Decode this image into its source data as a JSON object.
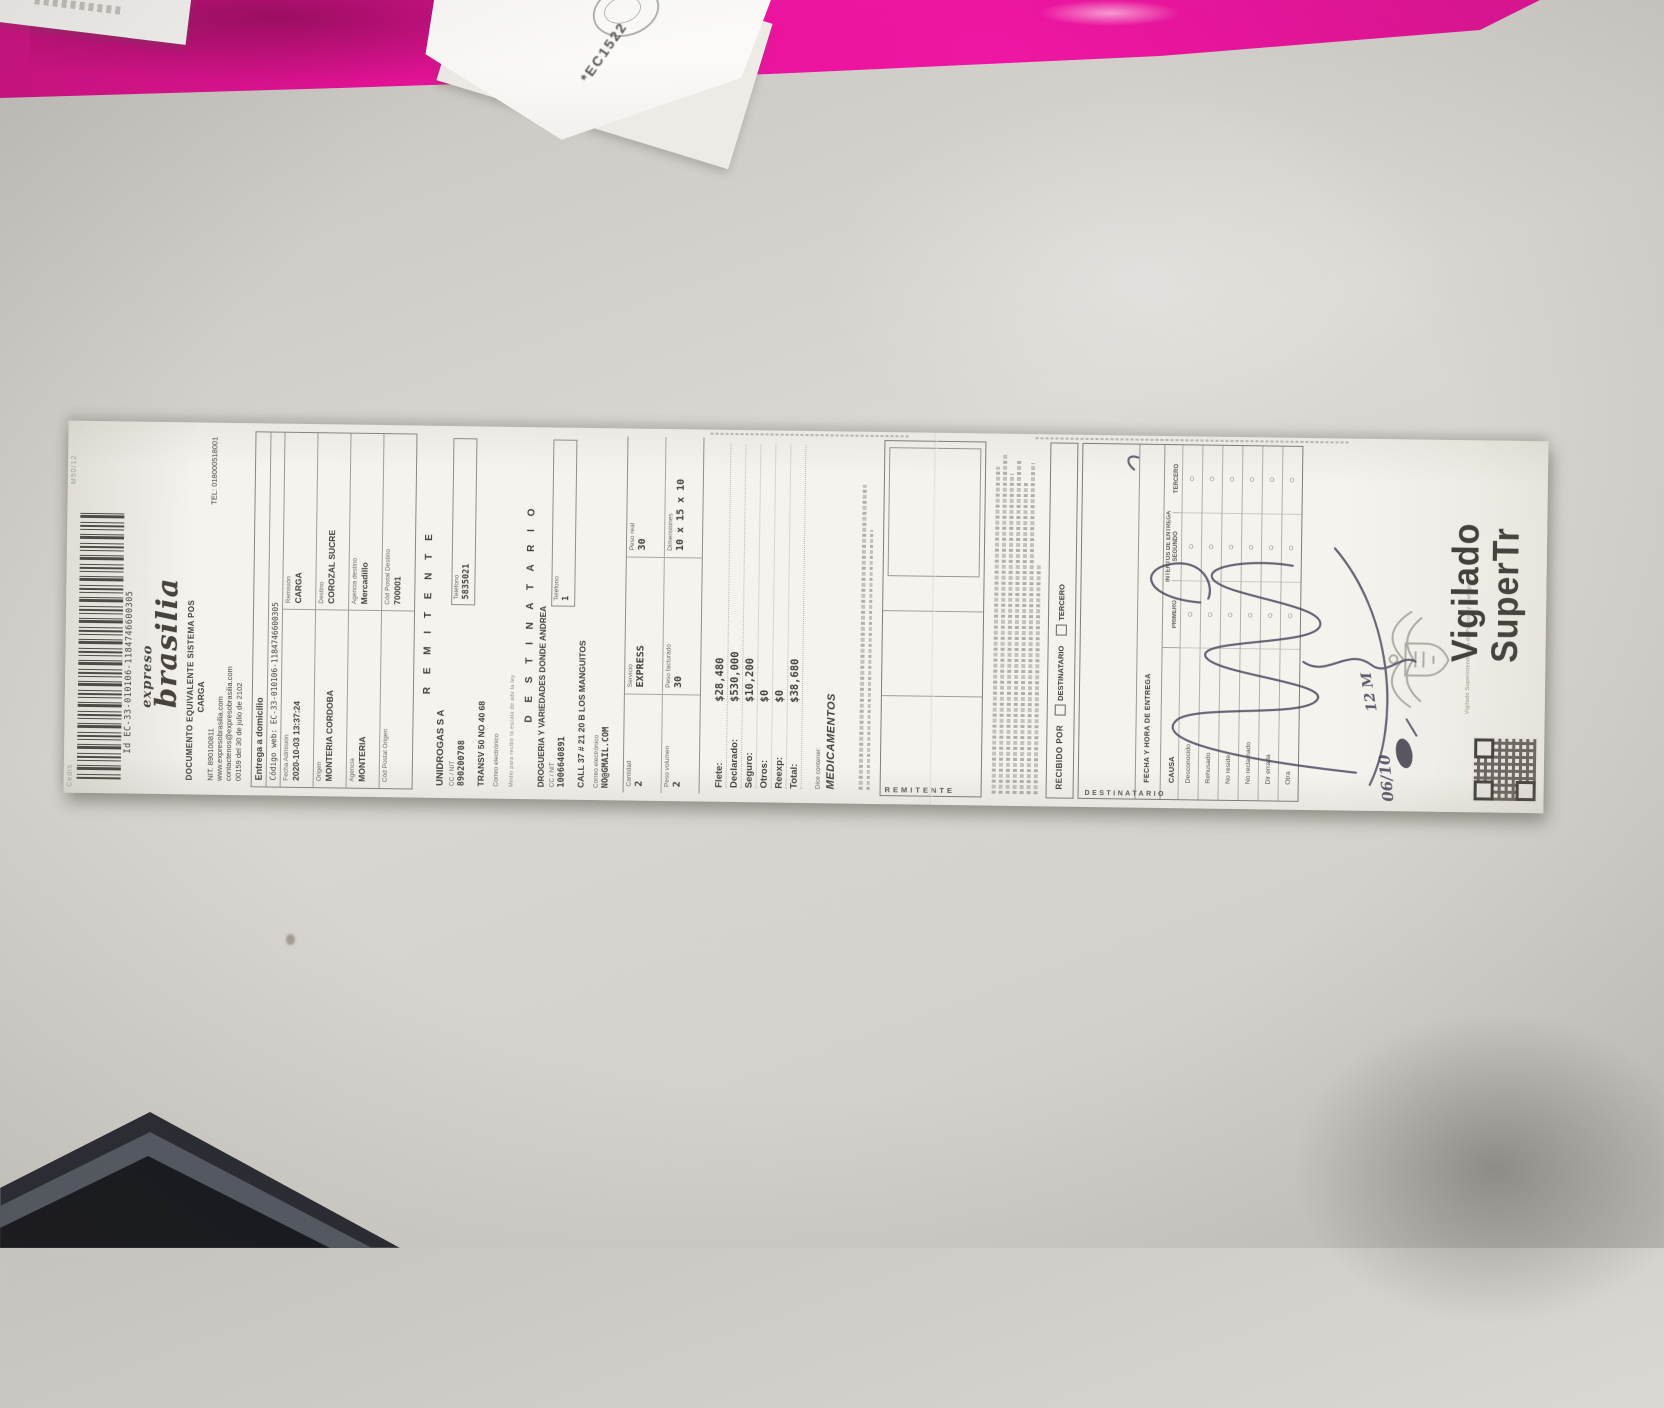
{
  "scene": {
    "paper_scrap_code": "*EC1522",
    "folder_color": "#ea129b",
    "desk_color": "#d5d2cd"
  },
  "receipt": {
    "edge_code_left": "Cedis",
    "edge_code_right": "M50/12",
    "barcode_id_label": "Id",
    "barcode_value": "EC-33-010106-1184746600305",
    "brand": {
      "line1": "expreso",
      "line2": "brasilia"
    },
    "doc_title": "DOCUMENTO EQUIVALENTE SISTEMA POS",
    "doc_subtitle": "CARGA",
    "nit": "NIT. 890100811",
    "tel": "TEL: 018000518001",
    "web": "www.expresobrasilia.com",
    "email": "contactenos@expresobrasilia.com",
    "resolution": "00159 del 30 de julio de 2102",
    "service_type": "Entrega a domicilio",
    "web_code_label": "Código web:",
    "web_code": "EC-33-010106-1184746600305",
    "info_rows": [
      {
        "l_label": "Fecha Admisión",
        "l_value": "2020-10-03 13:37:24",
        "r_label": "Remisión",
        "r_value": "CARGA"
      },
      {
        "l_label": "Origen",
        "l_value": "MONTERIA CORDOBA",
        "r_label": "Destino",
        "r_value": "COROZAL SUCRE"
      },
      {
        "l_label": "Agencia",
        "l_value": "MONTERIA",
        "r_label": "Agencia destino",
        "r_value": "Mercadillo"
      },
      {
        "l_label": "Cód Postal Origen",
        "l_value": "",
        "r_label": "Cód Postal Destino",
        "r_value": "700001"
      }
    ],
    "sender": {
      "section": "R E M I T E N T E",
      "name": "UNIDROGAS S A",
      "id_label": "CC / NIT",
      "id": "890200708",
      "phone_label": "Teléfono",
      "phone": "5835021",
      "address": "TRANSV 50 NO 40 68",
      "email_label": "Correo electrónico",
      "email": "",
      "note": "Medio para recibir la escala de adv la ley"
    },
    "recipient": {
      "section": "D E S T I N A T A R I O",
      "name": "DROGUERIA Y VARIEDADES DONDE ANDREA",
      "id_label": "CC / NIT",
      "id": "1006640891",
      "phone_label": "Teléfono",
      "phone": "1",
      "address": "CALL 37 # 21 20 B LOS MANGUITOS",
      "email_label": "Correo electrónico",
      "email": "NO@GMAIL.COM"
    },
    "package": {
      "rows": [
        [
          {
            "label": "Cantidad",
            "value": "2"
          },
          {
            "label": "Servicio",
            "value": "EXPRESS"
          },
          {
            "label": "Peso real",
            "value": "30"
          }
        ],
        [
          {
            "label": "Peso volumen",
            "value": "2"
          },
          {
            "label": "Peso facturado",
            "value": "30"
          },
          {
            "label": "Dimensiones",
            "value": "10 x 15 x 10"
          }
        ]
      ]
    },
    "totals": [
      {
        "label": "Flete:",
        "value": "$28,480"
      },
      {
        "label": "Declarado:",
        "value": "$530,000"
      },
      {
        "label": "Seguro:",
        "value": "$10,200"
      },
      {
        "label": "Otros:",
        "value": "$0"
      },
      {
        "label": "Reexp:",
        "value": "$0"
      },
      {
        "label": "Total:",
        "value": "$38,680"
      }
    ],
    "contents_label": "Dice contener:",
    "contents": "MEDICAMENTOS",
    "sender_box_label": "REMITENTE",
    "recipient_box_label": "DESTINATARIO",
    "delivery": {
      "received_by": "RECIBIDO POR",
      "checkboxes": [
        "DESTINATARIO",
        "TERCERO"
      ],
      "datetime_label": "FECHA Y HORA DE ENTREGA",
      "attempts_label": "INTENTOS DE ENTREGA",
      "attempt_cols": [
        "PRIMERO",
        "SEGUNDO",
        "TERCERO"
      ],
      "cause_label": "CAUSA",
      "causes": [
        "Desconocido",
        "Rehusado",
        "No reside",
        "No reclamado",
        "Dir errada",
        "Otra"
      ],
      "handwritten_date": "06/10",
      "handwritten_time": "12 M"
    },
    "watchdog": {
      "line1": "Vigilado",
      "line2": "SuperTr",
      "caption": "Vigilado Superintendencia de Puertos y Transporte"
    }
  }
}
